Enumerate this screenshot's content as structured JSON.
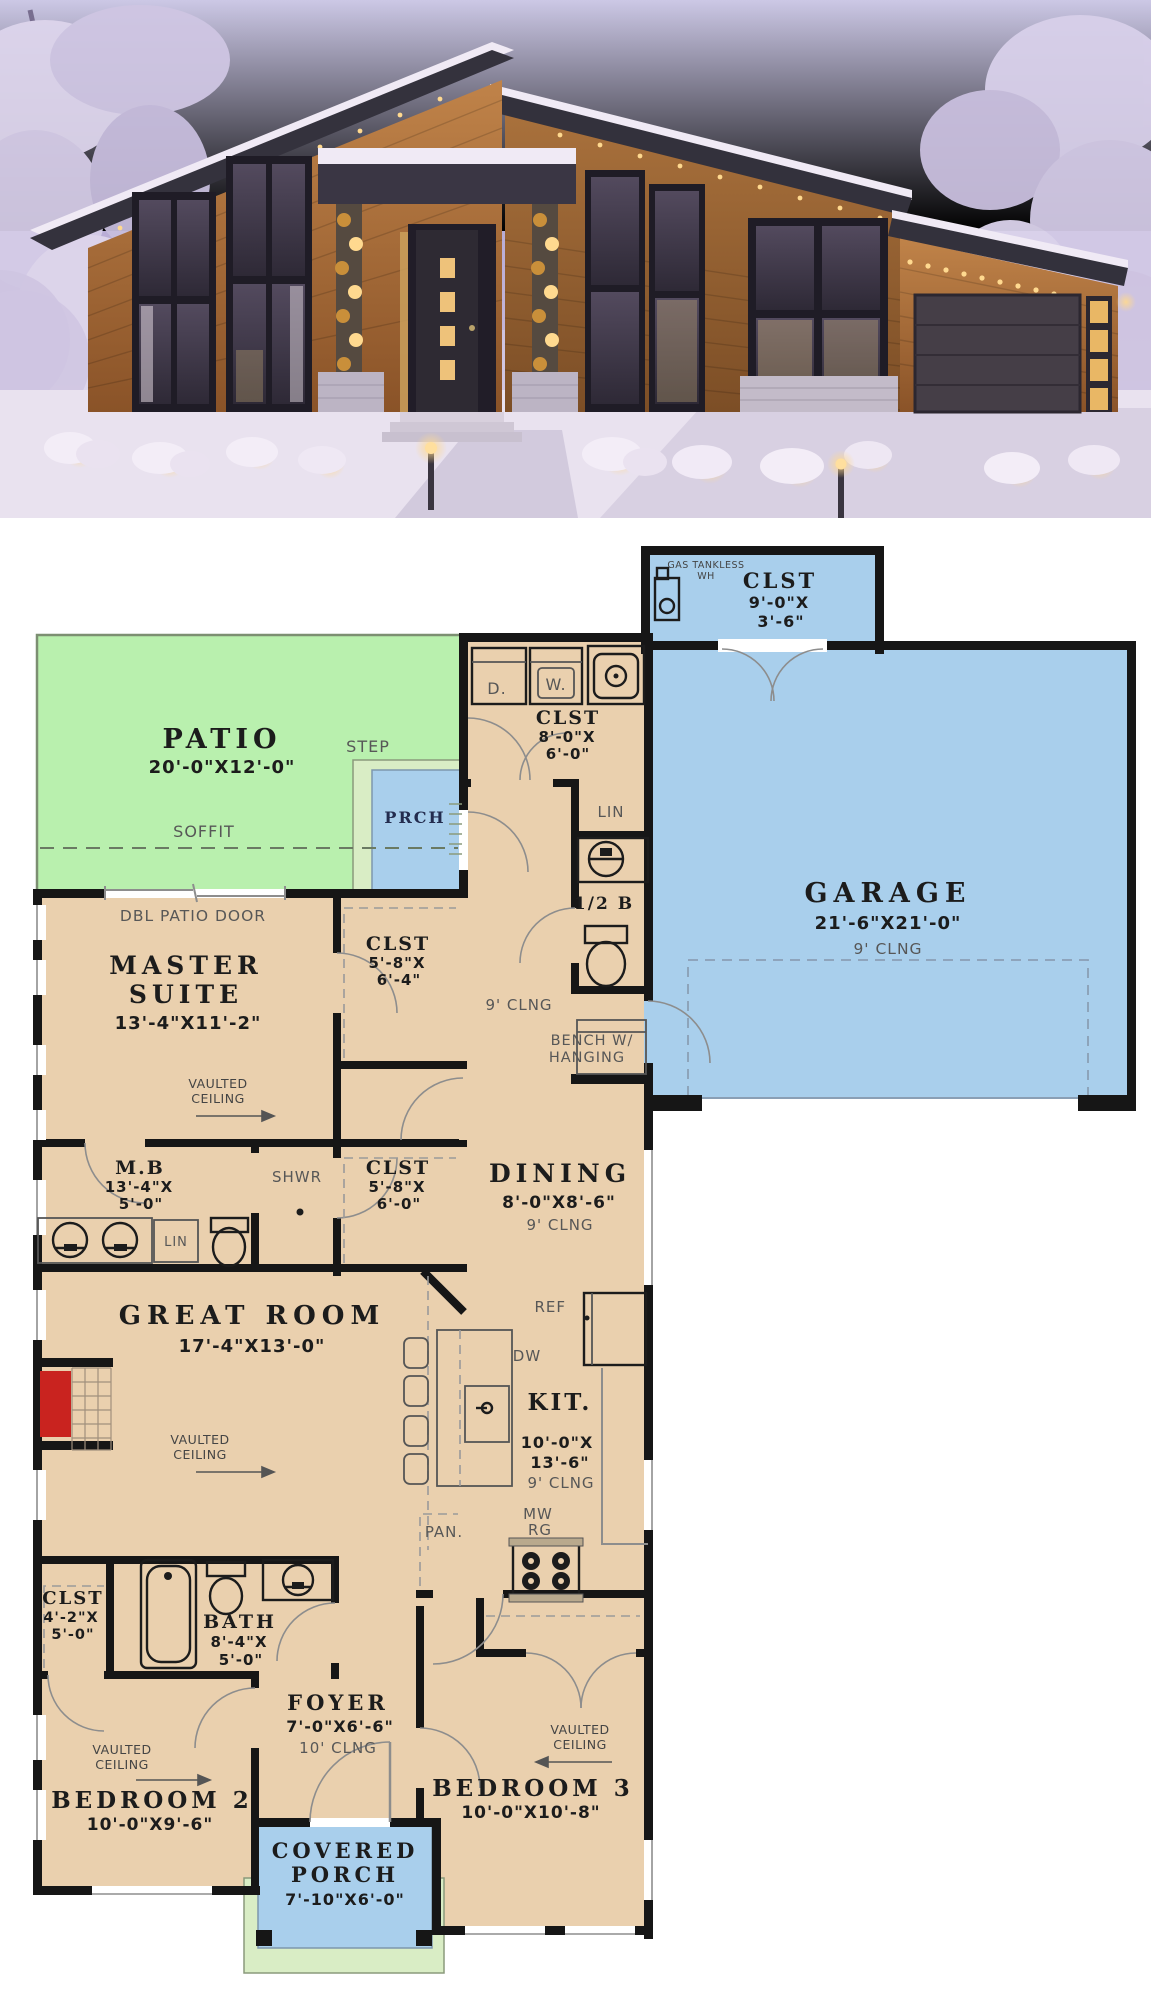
{
  "plan": {
    "patio": {
      "name": "PATIO",
      "dims": "20'-0\"X12'-0\""
    },
    "step": "STEP",
    "soffit": "SOFFIT",
    "prch": "PRCH",
    "wh_l1": "GAS TANKLESS",
    "wh_l2": "WH",
    "clst_wh": {
      "name": "CLST",
      "d1": "9'-0\"X",
      "d2": "3'-6\""
    },
    "garage": {
      "name": "GARAGE",
      "dims": "21'-6\"X21'-0\"",
      "clng": "9' CLNG"
    },
    "dryer": "D.",
    "washer": "W.",
    "clst_laundry": {
      "name": "CLST",
      "d1": "8'-0\"X",
      "d2": "6'-0\""
    },
    "lin_hall": "LIN",
    "half_bath": "1/2 B",
    "hall_clng": "9' CLNG",
    "bench_l1": "BENCH W/",
    "bench_l2": "HANGING",
    "dbl_patio_door": "DBL PATIO DOOR",
    "master": {
      "l1": "MASTER",
      "l2": "SUITE",
      "dims": "13'-4\"X11'-2\""
    },
    "vaulted_l1": "VAULTED",
    "vaulted_l2": "CEILING",
    "clst_m1": {
      "name": "CLST",
      "d1": "5'-8\"X",
      "d2": "6'-4\""
    },
    "mb": {
      "name": "M.B",
      "d1": "13'-4\"X",
      "d2": "5'-0\""
    },
    "lin_mb": "LIN",
    "shwr": "SHWR",
    "clst_m2": {
      "name": "CLST",
      "d1": "5'-8\"X",
      "d2": "6'-0\""
    },
    "dining": {
      "name": "DINING",
      "dims": "8'-0\"X8'-6\"",
      "clng": "9' CLNG"
    },
    "great": {
      "name": "GREAT ROOM",
      "dims": "17'-4\"X13'-0\""
    },
    "kit": {
      "name": "KIT.",
      "d1": "10'-0\"X",
      "d2": "13'-6\"",
      "clng": "9' CLNG"
    },
    "ref": "REF",
    "dw": "DW",
    "mw": "MW",
    "rg": "RG",
    "pan": "PAN.",
    "clst_b2": {
      "name": "CLST",
      "d1": "4'-2\"X",
      "d2": "5'-0\""
    },
    "bath": {
      "name": "BATH",
      "d1": "8'-4\"X",
      "d2": "5'-0\""
    },
    "foyer": {
      "name": "FOYER",
      "dims": "7'-0\"X6'-6\"",
      "clng": "10' CLNG"
    },
    "bedroom2": {
      "name": "BEDROOM 2",
      "dims": "10'-0\"X9'-6\""
    },
    "bedroom3": {
      "name": "BEDROOM 3",
      "dims": "10'-0\"X10'-8\""
    },
    "porch": {
      "l1": "COVERED",
      "l2": "PORCH",
      "dims": "7'-10\"X6'-0\""
    }
  },
  "colors": {
    "room_fill": "#ead0ae",
    "patio_green": "#b9f0ae",
    "step_green": "#d9edc5",
    "water_blue": "#a9cfec",
    "wall": "#161616",
    "label_gray": "#575757",
    "fireplace_red": "#c9231f"
  }
}
